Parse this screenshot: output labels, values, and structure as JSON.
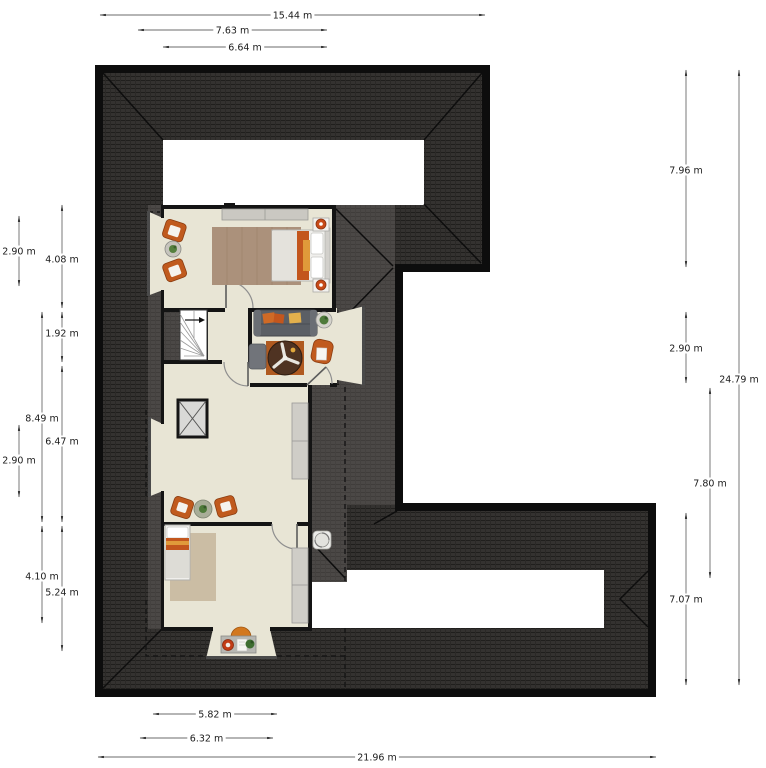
{
  "plan": {
    "type": "attic-floor-plan",
    "colors": {
      "roof_tiles": "#343230",
      "roof_shadow": "#4b4846",
      "floor": "#e8e5d5",
      "wall": "#141414",
      "accent_orange": "#c05a1e",
      "rug_brown": "#ab917b",
      "rug_tan": "#cbbda4",
      "dimension_line": "#6b6b6b",
      "dimension_text": "#1b1b1b"
    },
    "rooms": [
      {
        "name": "bedroom-top",
        "furniture": [
          "dresser",
          "rug",
          "double-bed",
          "nightstand-lamp",
          "nightstand-lamp",
          "armchair",
          "armchair",
          "side-table-plant"
        ]
      },
      {
        "name": "sitting-room",
        "furniture": [
          "sofa",
          "side-table-plant",
          "round-table-fan",
          "desk-chair",
          "office-chair"
        ]
      },
      {
        "name": "stair-hall",
        "furniture": [
          "winder-stairs",
          "void-shaft",
          "cabinet",
          "armchair",
          "armchair",
          "side-table-plant"
        ]
      },
      {
        "name": "bedroom-bottom",
        "furniture": [
          "single-bed",
          "rug",
          "wardrobe",
          "ceiling-fan",
          "desk",
          "desk-chair",
          "stool",
          "plant"
        ]
      }
    ]
  },
  "dimensions": [
    {
      "label": "15.44 m",
      "orient": "h",
      "x1": 100,
      "x2": 485,
      "y": 15
    },
    {
      "label": "7.63 m",
      "orient": "h",
      "x1": 138,
      "x2": 327,
      "y": 30
    },
    {
      "label": "6.64 m",
      "orient": "h",
      "x1": 163,
      "x2": 327,
      "y": 47
    },
    {
      "label": "5.82 m",
      "orient": "h",
      "x1": 153,
      "x2": 277,
      "y": 714
    },
    {
      "label": "6.32 m",
      "orient": "h",
      "x1": 140,
      "x2": 273,
      "y": 738
    },
    {
      "label": "21.96 m",
      "orient": "h",
      "x1": 98,
      "x2": 656,
      "y": 757
    },
    {
      "label": "2.90 m",
      "orient": "v",
      "x": 19,
      "y1": 216,
      "y2": 286,
      "t": 251
    },
    {
      "label": "4.08 m",
      "orient": "v",
      "x": 62,
      "y1": 205,
      "y2": 308,
      "t": 259
    },
    {
      "label": "1.92 m",
      "orient": "v",
      "x": 62,
      "y1": 312,
      "y2": 362,
      "t": 333
    },
    {
      "label": "8.49 m",
      "orient": "v",
      "x": 42,
      "y1": 312,
      "y2": 522,
      "t": 418
    },
    {
      "label": "6.47 m",
      "orient": "v",
      "x": 62,
      "y1": 366,
      "y2": 522,
      "t": 441
    },
    {
      "label": "2.90 m",
      "orient": "v",
      "x": 19,
      "y1": 425,
      "y2": 497,
      "t": 460
    },
    {
      "label": "4.10 m",
      "orient": "v",
      "x": 42,
      "y1": 526,
      "y2": 623,
      "t": 576
    },
    {
      "label": "5.24 m",
      "orient": "v",
      "x": 62,
      "y1": 526,
      "y2": 651,
      "t": 592
    },
    {
      "label": "7.96 m",
      "orient": "v",
      "x": 686,
      "y1": 70,
      "y2": 267,
      "t": 170
    },
    {
      "label": "2.90 m",
      "orient": "v",
      "x": 686,
      "y1": 312,
      "y2": 383,
      "t": 348
    },
    {
      "label": "7.07 m",
      "orient": "v",
      "x": 686,
      "y1": 513,
      "y2": 685,
      "t": 599
    },
    {
      "label": "7.80 m",
      "orient": "v",
      "x": 710,
      "y1": 388,
      "y2": 578,
      "t": 483
    },
    {
      "label": "24.79 m",
      "orient": "v",
      "x": 739,
      "y1": 70,
      "y2": 685,
      "t": 379
    }
  ]
}
